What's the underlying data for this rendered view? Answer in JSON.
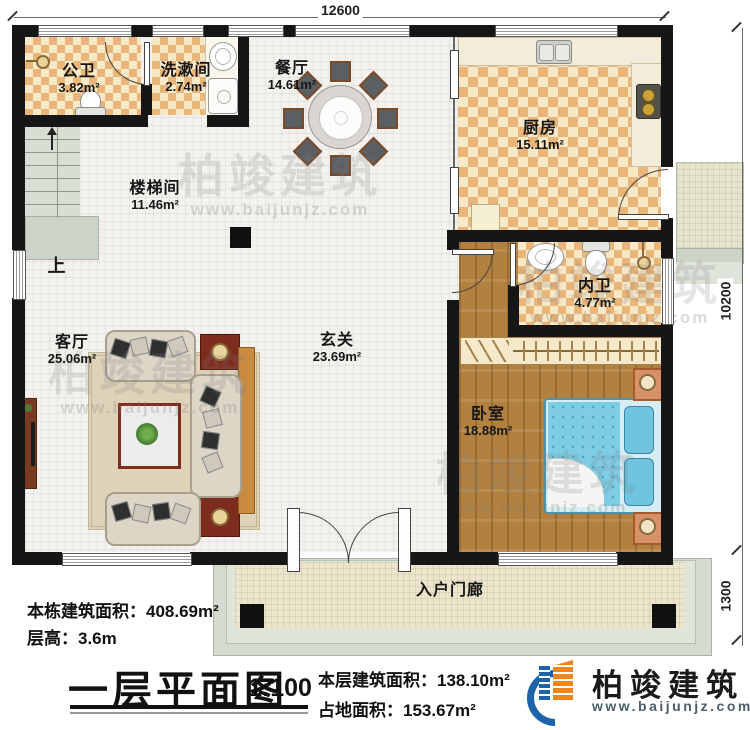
{
  "plan": {
    "dimensions": {
      "top": "12600",
      "right_upper": "10200",
      "right_lower": "1300"
    },
    "rooms": [
      {
        "id": "public-bath",
        "name": "公卫",
        "area": "3.82m²"
      },
      {
        "id": "washroom",
        "name": "洗漱间",
        "area": "2.74m²"
      },
      {
        "id": "dining",
        "name": "餐厅",
        "area": "14.61m²"
      },
      {
        "id": "kitchen",
        "name": "厨房",
        "area": "15.11m²"
      },
      {
        "id": "stairwell",
        "name": "楼梯间",
        "area": "11.46m²"
      },
      {
        "id": "ensuite",
        "name": "内卫",
        "area": "4.77m²"
      },
      {
        "id": "foyer",
        "name": "玄关",
        "area": "23.69m²"
      },
      {
        "id": "living",
        "name": "客厅",
        "area": "25.06m²"
      },
      {
        "id": "bedroom",
        "name": "卧室",
        "area": "18.88m²"
      },
      {
        "id": "porch",
        "name": "入户门廊",
        "area": ""
      }
    ],
    "stairs_direction": "上"
  },
  "annotations": {
    "building_area_label": "本栋建筑面积：",
    "building_area_value": "408.69m²",
    "floor_height_label": "层高：",
    "floor_height_value": "3.6m",
    "title": "一层平面图",
    "scale": "1:100",
    "floor_area_label": "本层建筑面积：",
    "floor_area_value": "138.10m²",
    "ground_area_label": "占地面积：",
    "ground_area_value": "153.67m²"
  },
  "branding": {
    "company": "柏竣建筑",
    "website": "www.baijunjz.com"
  },
  "watermark": {
    "text": "柏竣建筑",
    "subtext": "www.baijunjz.com"
  },
  "colors": {
    "wall": "#161616",
    "checker_tan": "#e9b579",
    "checker_cream": "#f7e8c8",
    "wood": "#b2813f",
    "bed_blue": "#7fcde5",
    "brand_blue": "#1c63a9",
    "brand_orange": "#f08519"
  }
}
